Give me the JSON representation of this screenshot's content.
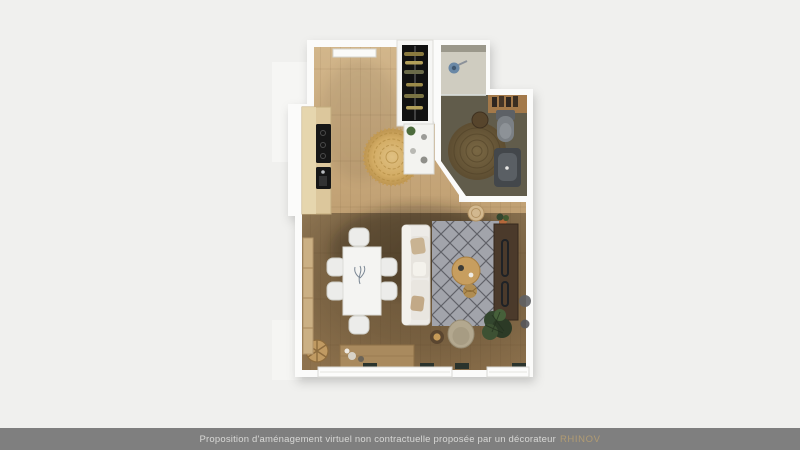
{
  "page": {
    "bg": "#f0f0ee"
  },
  "footer": {
    "bg": "#7f7f7f",
    "text_color": "#d8d8d6",
    "disclaimer": "Proposition d'aménagement virtuel non contractuelle proposée par un décorateur",
    "brand": "RHINOV",
    "brand_color": "#b19b72"
  },
  "palette": {
    "page_bg": "#f0f0ee",
    "footer_bg": "#7f7f7f",
    "footer_text": "#d8d8d6",
    "brand_color": "#b19b72",
    "slab": "#fbfbfa",
    "wood_light": "#cdb084",
    "wood_dark": "#9c7f57",
    "bath_floor": "#615c4b",
    "shower_floor": "#cfccc0",
    "counter_wood": "#dcc79c",
    "appliance_black": "#161616",
    "rug_jute": "#6e5c3c",
    "rug_entry": "#d2ab63",
    "rug_living": "#a2a4ab",
    "sofa_white": "#edebe7",
    "table_white": "#f4f4f2",
    "sideboard_brown": "#4b3a2b",
    "plant_green": "#33462e",
    "accent_tan": "#c79e5f"
  }
}
